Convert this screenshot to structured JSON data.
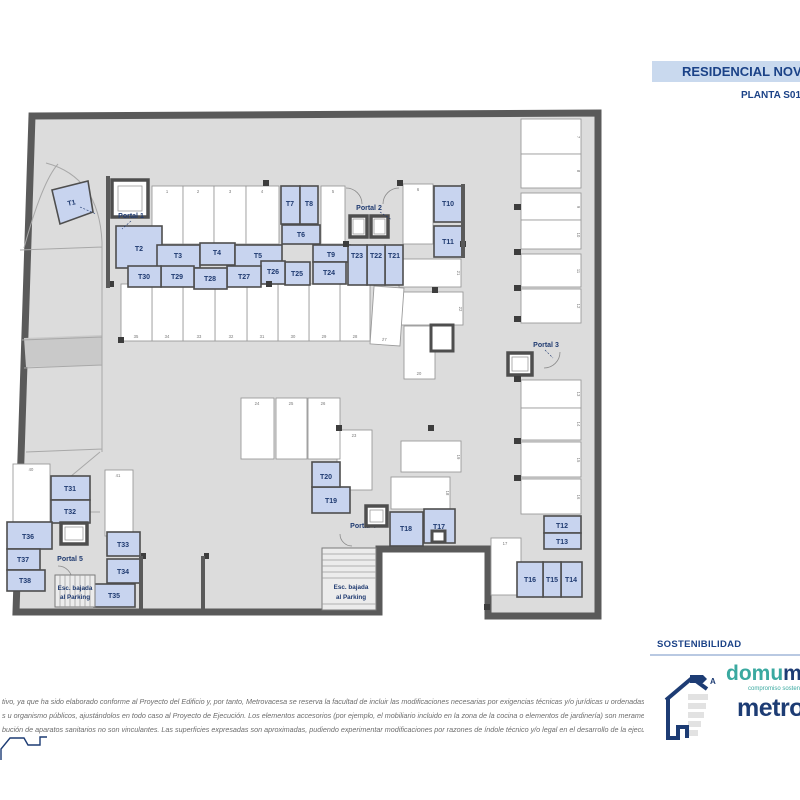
{
  "header": {
    "project_bar": "RESIDENCIAL NOVA",
    "plan_title": "PLANTA S01"
  },
  "plan": {
    "rooms": {
      "t1": "T1",
      "t2": "T2",
      "t3": "T3",
      "t4": "T4",
      "t5": "T5",
      "t6": "T6",
      "t7": "T7",
      "t8": "T8",
      "t9": "T9",
      "t10": "T10",
      "t11": "T11",
      "t12": "T12",
      "t13": "T13",
      "t14": "T14",
      "t15": "T15",
      "t16": "T16",
      "t17": "T17",
      "t18": "T18",
      "t19": "T19",
      "t20": "T20",
      "t21": "T21",
      "t22": "T22",
      "t23": "T23",
      "t24": "T24",
      "t25": "T25",
      "t26": "T26",
      "t27": "T27",
      "t28": "T28",
      "t29": "T29",
      "t30": "T30",
      "t31": "T31",
      "t32": "T32",
      "t33": "T33",
      "t34": "T34",
      "t35": "T35",
      "t36": "T36",
      "t37": "T37",
      "t38": "T38"
    },
    "portals": {
      "p1": "Portal 1",
      "p2": "Portal 2",
      "p3": "Portal 3",
      "p4": "Portal 4",
      "p5": "Portal 5"
    },
    "stairs": {
      "line1": "Esc. bajada",
      "line2": "al Parking"
    },
    "parking": {
      "s1": "1",
      "s2": "2",
      "s3": "3",
      "s4": "4",
      "s5": "5",
      "s6": "6",
      "s7": "7",
      "s8": "8",
      "s9": "9",
      "s10": "10",
      "s11": "11",
      "s12": "12",
      "s13": "13",
      "s14": "14",
      "s15": "15",
      "s16": "16",
      "s17": "17",
      "s18": "18",
      "s19": "19",
      "s20": "20",
      "s21": "21",
      "s22": "22",
      "s23": "23",
      "s24": "24",
      "s25": "25",
      "s26": "26",
      "s27": "27",
      "s28": "28",
      "s29": "29",
      "s30": "30",
      "s31": "31",
      "s32": "32",
      "s33": "33",
      "s34": "34",
      "s35": "35",
      "s40": "40",
      "s41": "41"
    }
  },
  "disclaimer": {
    "line1": "tivo, ya que ha sido elaborado conforme al Proyecto del Edificio y, por tanto, Metrovacesa se reserva la facultad de incluir las modificaciones necesarias por exigencias técnicas y/o jurídicas u ordenadas por",
    "line2": "s u organismo públicos, ajustándolos en todo caso al Proyecto de Ejecución. Los elementos accesorios (por ejemplo, el mobiliario incluido en la zona de la cocina o elementos de jardinería) son meramente ilustrativos.",
    "line3": "bución de aparatos sanitarios no son vinculantes. Las superficies expresadas son aproximadas, pudiendo experimentar modificaciones por razones de índole técnico y/o legal en el desarrollo de la ejecución de las"
  },
  "branding": {
    "section_title": "SOSTENIBILIDAD",
    "domum_teal": "domu",
    "domum_rest": "m",
    "tagline": "compromiso sostenib",
    "metrovacesa": "metrova",
    "energy_letter": "A"
  }
}
